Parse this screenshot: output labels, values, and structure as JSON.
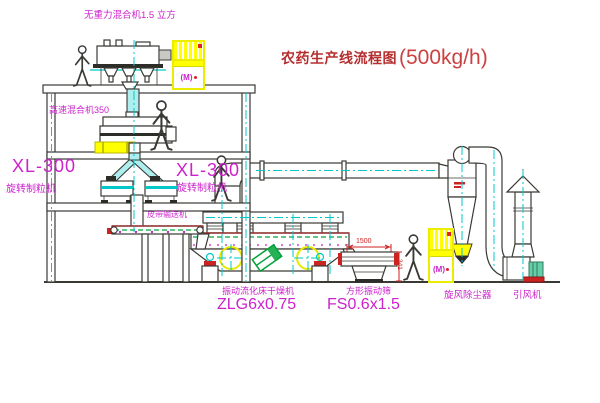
{
  "title": {
    "text": "农药生产线流程图",
    "capacity": "(500kg/h)"
  },
  "equipment_labels": {
    "top_mixer": "无重力混合机1.5 立方",
    "high_speed_mixer": "高速混合机350",
    "granulator_model_left": "XL-300",
    "granulator_name_left": "旋转制粒机",
    "granulator_model_right": "XL-300",
    "granulator_name_right": "旋转制粒机",
    "belt_conveyor": "皮带输送机",
    "fluid_bed_dryer": "振动流化床干燥机",
    "fluid_bed_dryer_model": "ZLG6x0.75",
    "square_vibrating_sieve": "方形振动筛",
    "square_vibrating_sieve_model": "FS0.6x1.5",
    "cyclone_dust_collector": "旋风除尘器",
    "induced_draft_fan": "引风机"
  },
  "dimensions": {
    "sieve_length": "1500",
    "sieve_height": "341"
  },
  "cabinets": {
    "panel_marking": "(M)"
  },
  "colors": {
    "label_magenta": "#cc22cc",
    "title_red": "#c23535",
    "line_dark": "#3a3a35",
    "centerline_cyan": "#00c8c8",
    "equipment_yellow": "#ffff00",
    "accent_green": "#00a33a",
    "accent_red": "#cc2222"
  }
}
